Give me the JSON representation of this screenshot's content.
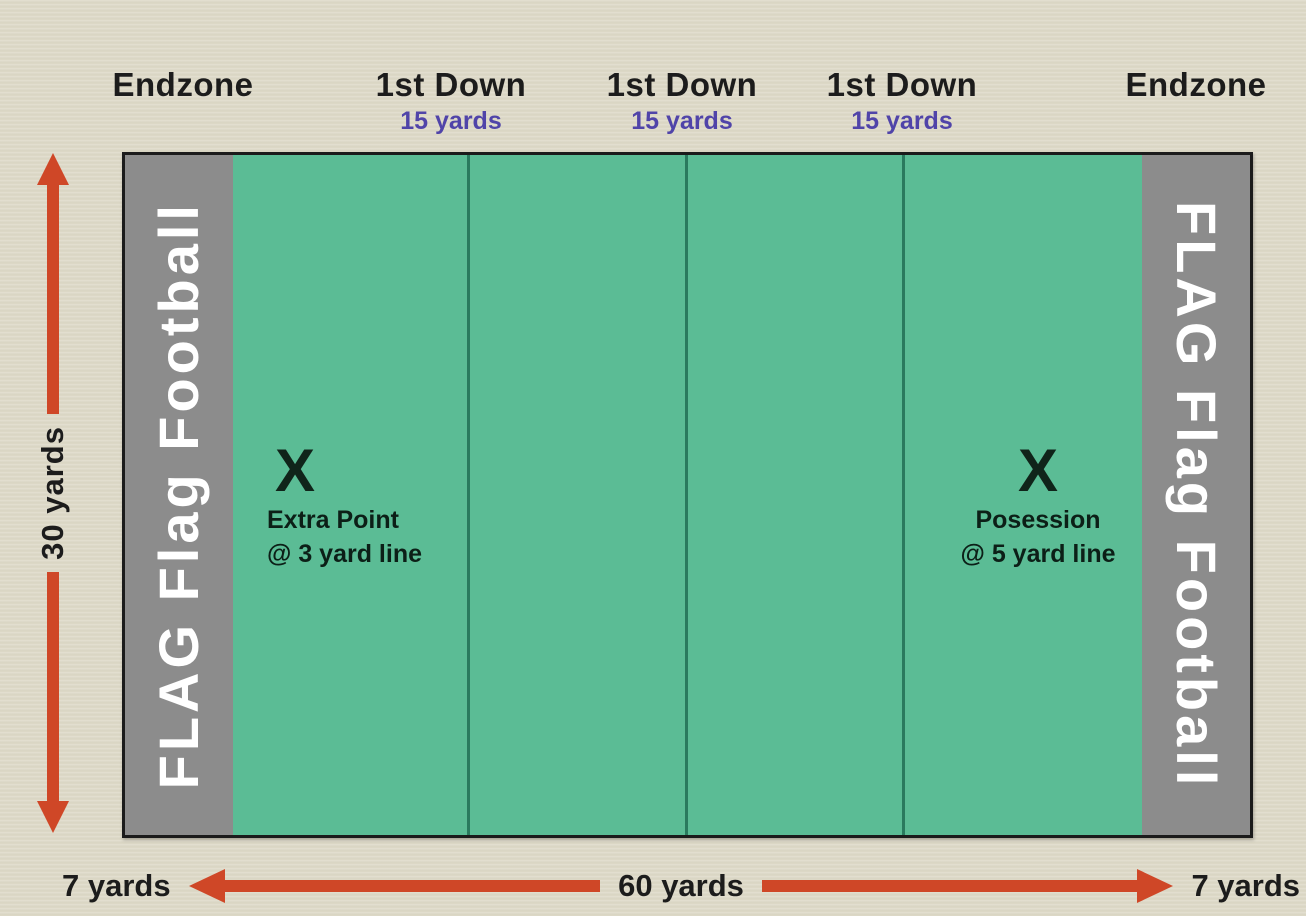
{
  "colors": {
    "background": "#dcd8c6",
    "field_green": "#5bbc95",
    "field_line_green": "#2a7a5e",
    "endzone_gray": "#8c8c8c",
    "arrow_red": "#cf4727",
    "yards_purple": "#5044a9",
    "text_black": "#1c1c1c",
    "endzone_text_white": "#ffffff",
    "field_border": "#1b1b1b"
  },
  "top_labels": {
    "endzone_left": "Endzone",
    "endzone_right": "Endzone",
    "first_down": [
      {
        "label": "1st Down",
        "sub": "15 yards"
      },
      {
        "label": "1st Down",
        "sub": "15 yards"
      },
      {
        "label": "1st Down",
        "sub": "15 yards"
      }
    ]
  },
  "field": {
    "endzone_text_left": "FLAG Flag Football",
    "endzone_text_right": "FLAG Flag Football",
    "markers": [
      {
        "symbol": "X",
        "line1": "Extra Point",
        "line2": "@ 3 yard line"
      },
      {
        "symbol": "X",
        "line1": "Posession",
        "line2": "@ 5 yard line"
      }
    ]
  },
  "dimensions": {
    "field_height": "30 yards",
    "endzone_width_left": "7 yards",
    "playfield_width": "60 yards",
    "endzone_width_right": "7 yards"
  }
}
